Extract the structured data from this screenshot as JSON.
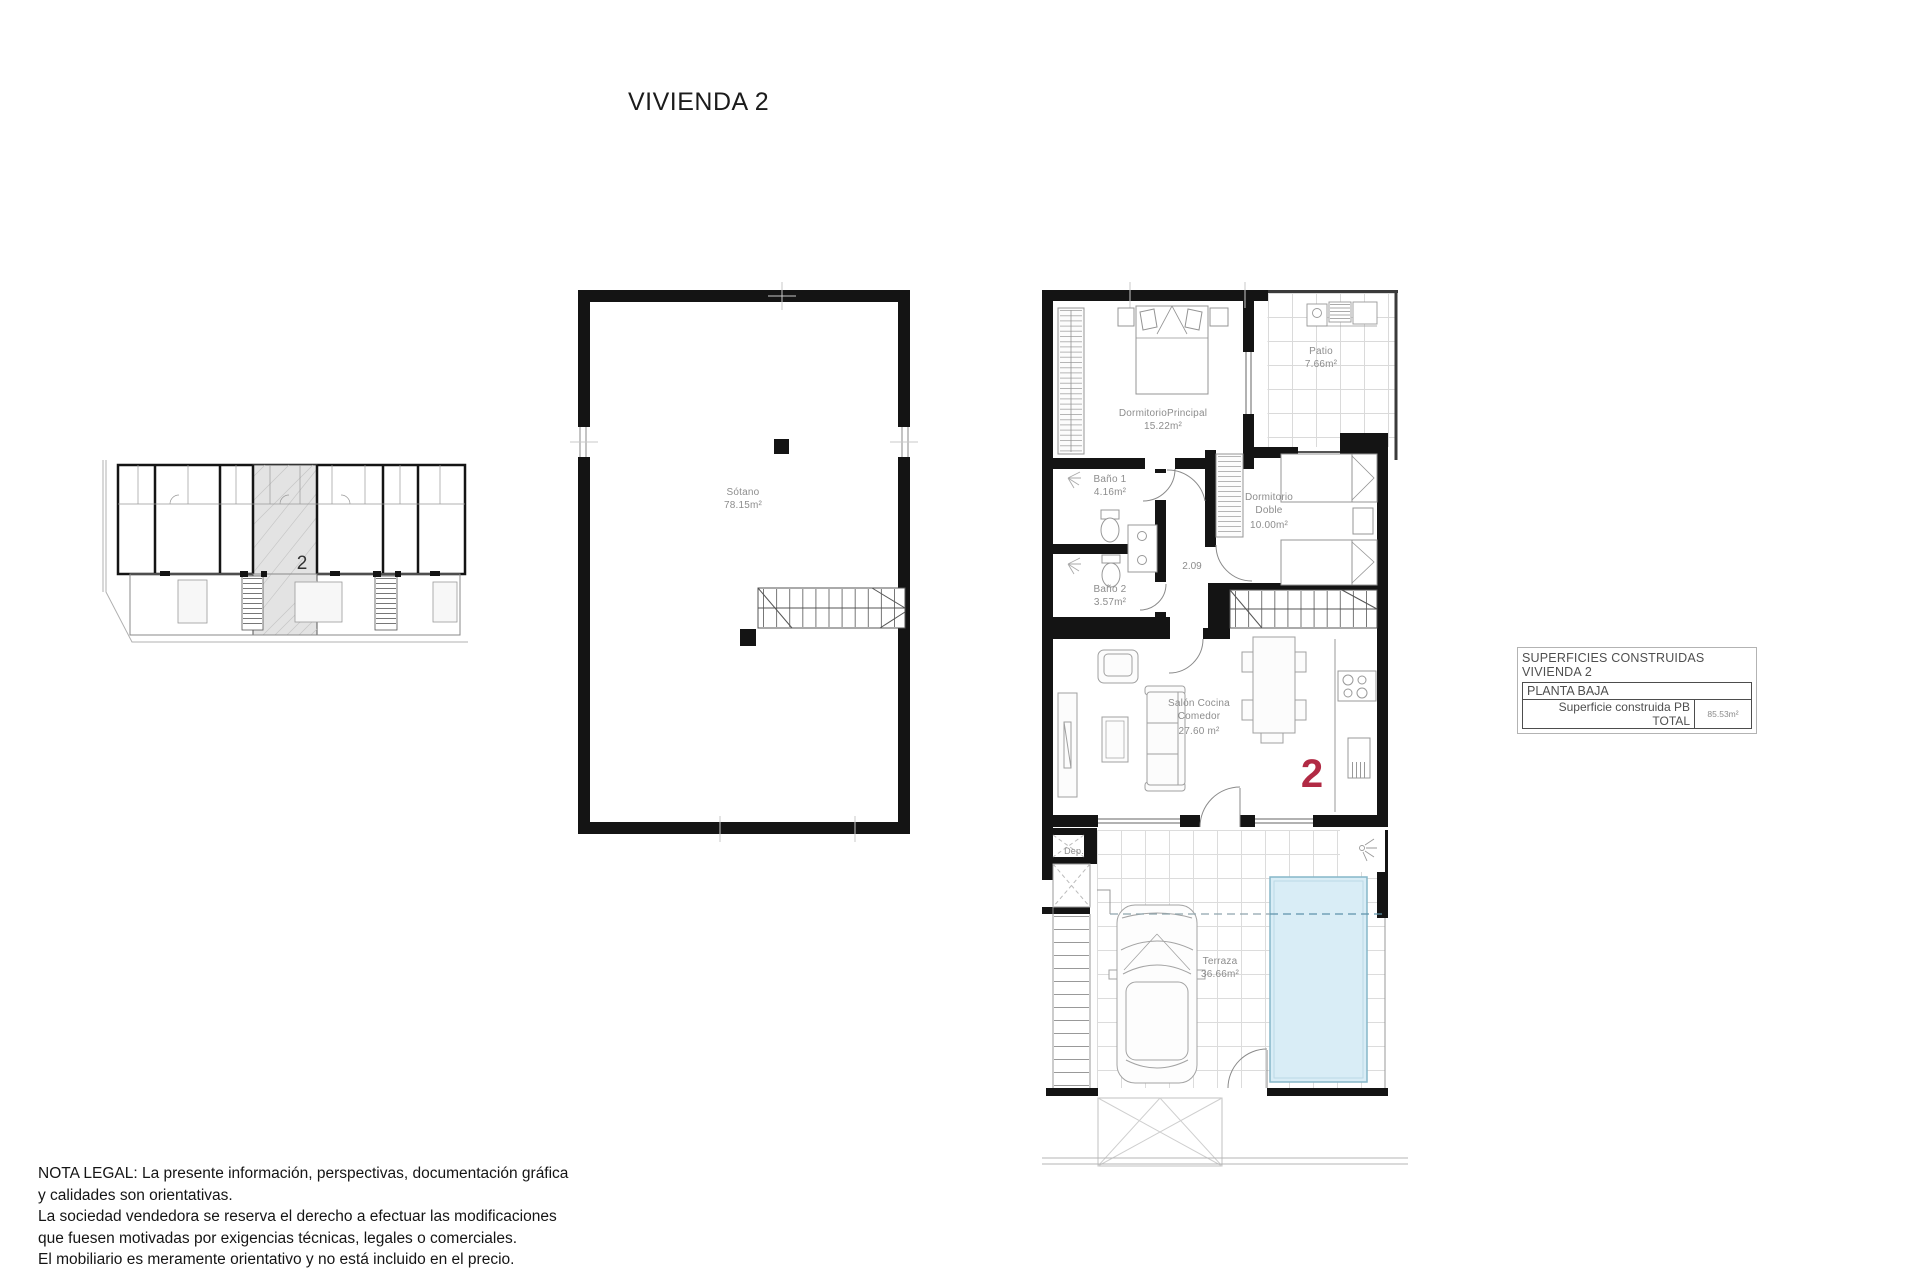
{
  "title": "VIVIENDA 2",
  "overview": {
    "unit_label": "2"
  },
  "basement": {
    "name": "Sótano",
    "area": "78.15m²"
  },
  "ground_floor": {
    "unit_number": "2",
    "hall_dimension": "2.09",
    "rooms": {
      "dormitorio_principal": {
        "name": "DormitorioPrincipal",
        "area": "15.22m²"
      },
      "patio": {
        "name": "Patio",
        "area": "7.66m²"
      },
      "bano1": {
        "name": "Baño 1",
        "area": "4.16m²"
      },
      "bano2": {
        "name": "Baño 2",
        "area": "3.57m²"
      },
      "dormitorio_doble": {
        "name": "Dormitorio Doble",
        "area": "10.00m²"
      },
      "salon": {
        "name": "Salón Cocina Comedor",
        "area": "27.60 m²"
      },
      "dep": {
        "name": "Dep."
      },
      "terraza": {
        "name": "Terraza",
        "area": "36.66m²"
      }
    }
  },
  "areas_table": {
    "title_line1": "SUPERFICIES CONSTRUIDAS",
    "title_line2": "VIVIENDA 2",
    "section": "PLANTA BAJA",
    "row_label": "Superficie construida PB TOTAL",
    "row_value": "85.53m²"
  },
  "legal": {
    "lines": [
      "NOTA LEGAL: La presente información, perspectivas, documentación gráfica",
      "y calidades son orientativas.",
      "La sociedad vendedora se reserva el derecho a efectuar las modificaciones",
      "que fuesen motivadas por exigencias técnicas, legales o comerciales.",
      "El mobiliario es meramente orientativo y no está incluido en el precio."
    ]
  },
  "colors": {
    "accent_red": "#b12a44",
    "pool_fill": "#d9edf6",
    "wall": "#141414"
  }
}
